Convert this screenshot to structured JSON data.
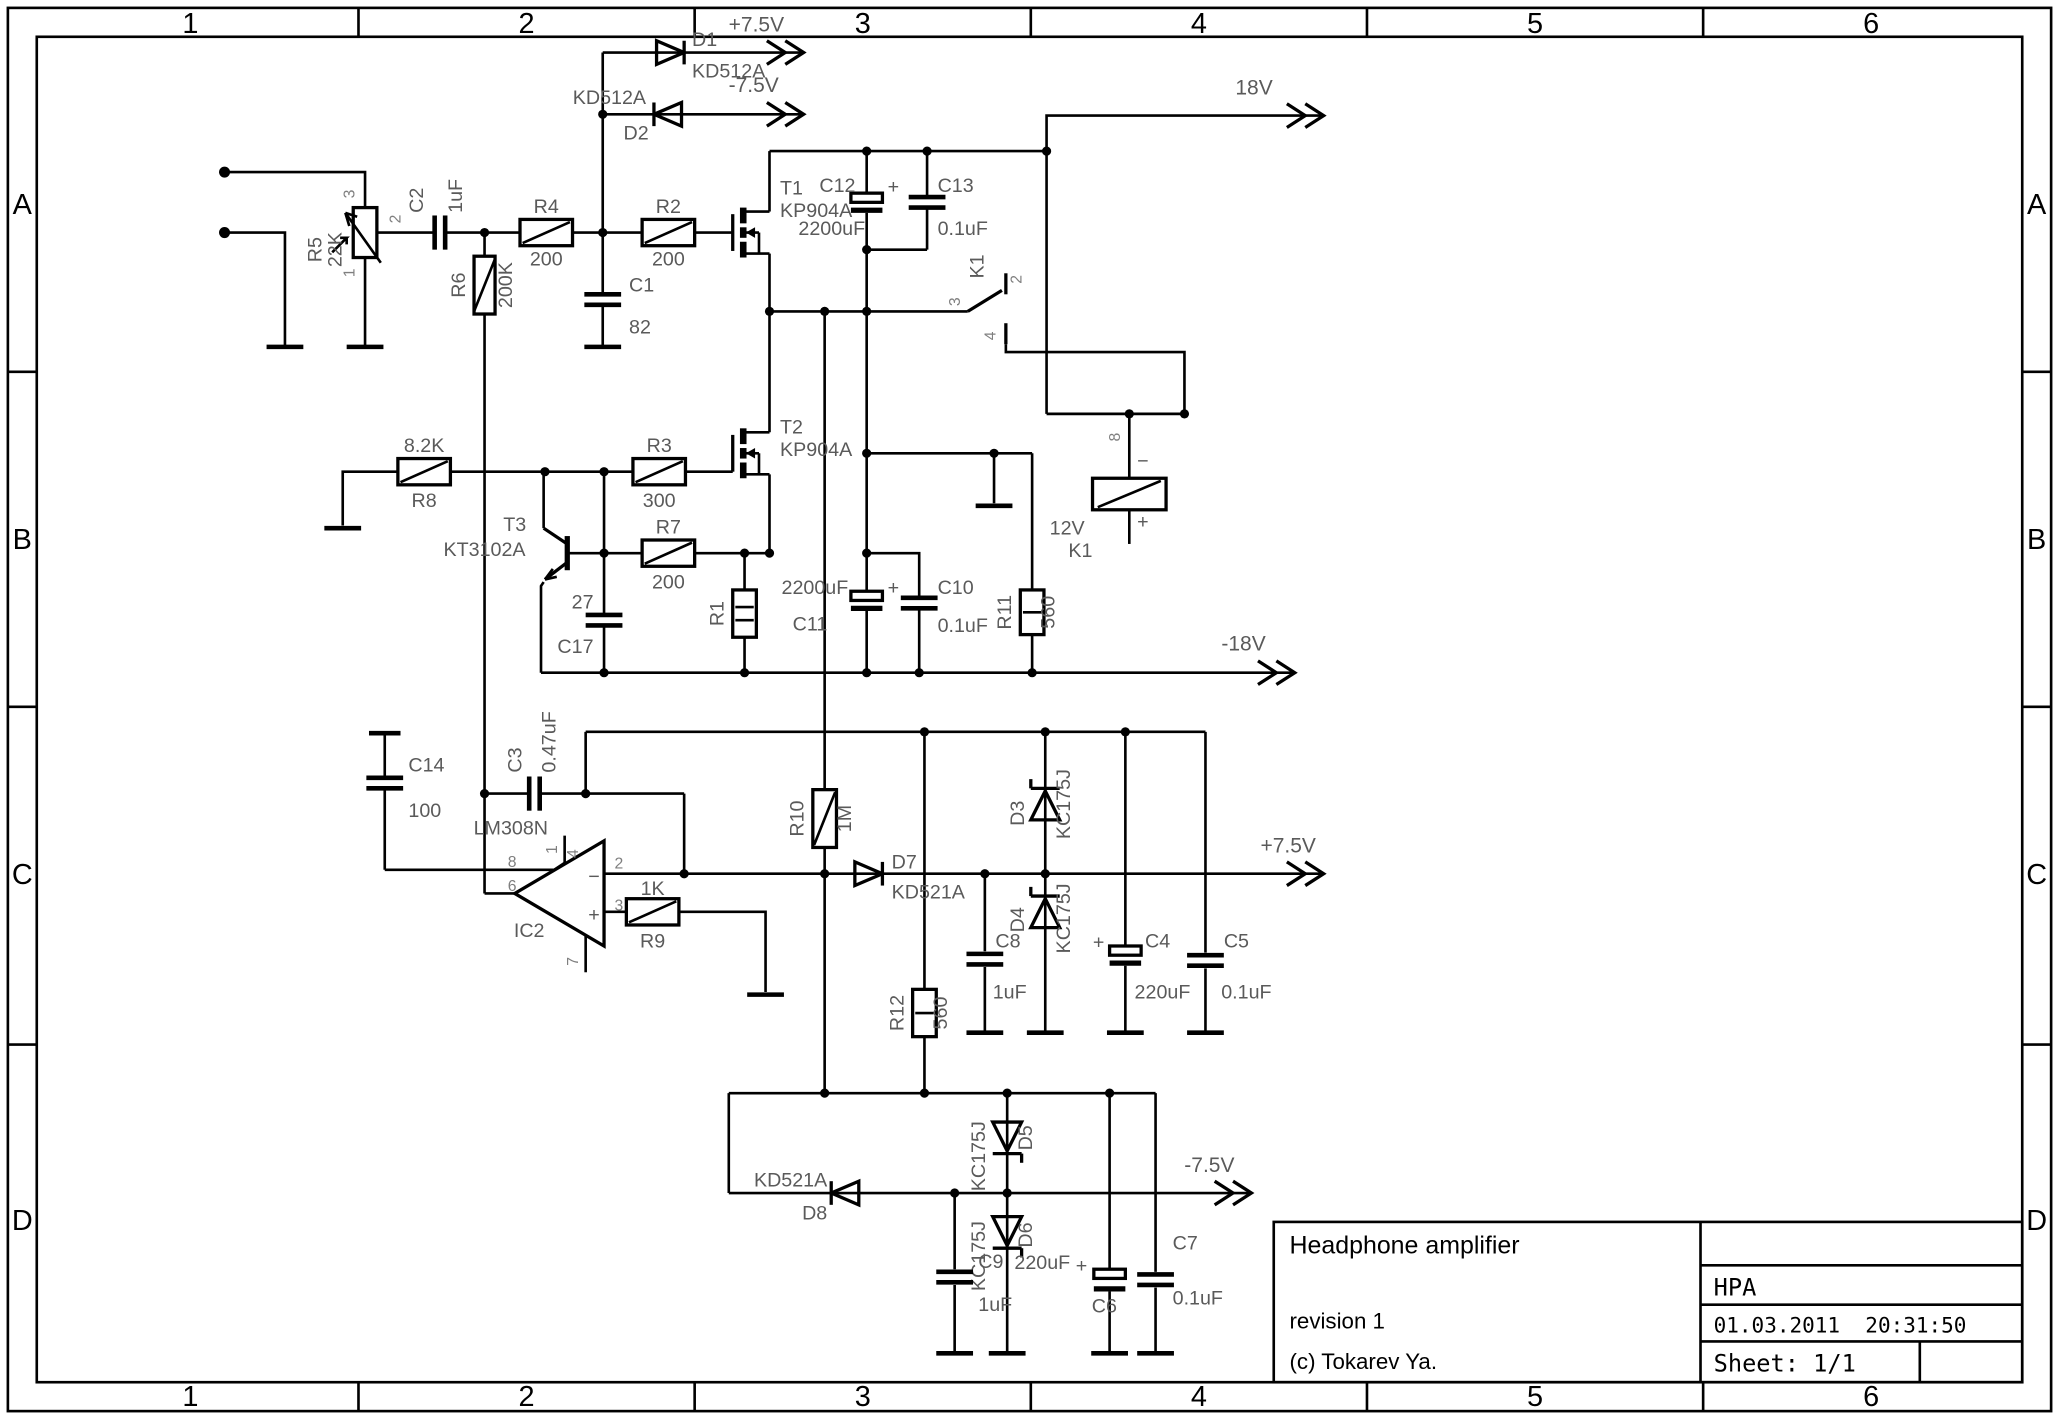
{
  "frame": {
    "columns": [
      "1",
      "2",
      "3",
      "4",
      "5",
      "6"
    ],
    "rows": [
      "A",
      "B",
      "C",
      "D"
    ]
  },
  "rails": {
    "p75_top": "+7.5V",
    "m75_top": "-7.5V",
    "p18": "18V",
    "m18": "-18V",
    "p75_mid": "+7.5V",
    "m75_bot": "-7.5V"
  },
  "title_block": {
    "title": "Headphone amplifier",
    "revision": "revision 1",
    "copyright": "(c) Tokarev Ya.",
    "code": "HPA",
    "datetime": "01.03.2011  20:31:50",
    "sheet": "Sheet: 1/1"
  },
  "colors": {
    "wire": "#000000",
    "label": "#5a5a5a",
    "background": "#ffffff"
  },
  "labels": {
    "d1_ref": "D1",
    "d1_val": "KD512A",
    "d2_ref": "D2",
    "d2_val": "KD512A",
    "r5_ref": "R5",
    "r5_val": "22K",
    "r5_p1": "1",
    "r5_p2": "2",
    "r5_p3": "3",
    "c2_ref": "C2",
    "c2_val": "1uF",
    "r6_ref": "R6",
    "r6_val": "200K",
    "r4_ref": "R4",
    "r4_val": "200",
    "c1_ref": "C1",
    "c1_val": "82",
    "r2_ref": "R2",
    "r2_val": "200",
    "t1_ref": "T1",
    "t1_val": "KP904A",
    "c12_ref": "C12",
    "c12_val": "2200uF",
    "c12_plus": "+",
    "c13_ref": "C13",
    "c13_val": "0.1uF",
    "k1sw_ref": "K1",
    "k1_p2": "2",
    "k1_p3": "3",
    "k1_p4": "4",
    "t2_ref": "T2",
    "t2_val": "KP904A",
    "r8_ref": "R8",
    "r8_val": "8.2K",
    "r3_ref": "R3",
    "r3_val": "300",
    "t3_ref": "T3",
    "t3_val": "KT3102A",
    "r7_ref": "R7",
    "r7_val": "200",
    "c17_ref": "C17",
    "c17_val": "27",
    "r1_ref": "R1",
    "c11_ref": "C11",
    "c11_val": "2200uF",
    "c11_plus": "+",
    "c10_ref": "C10",
    "c10_val": "0.1uF",
    "r11_ref": "R11",
    "r11_val": "560",
    "k1_ref": "K1",
    "k1_val": "12V",
    "k1_p8": "8",
    "k1_minus": "−",
    "k1_plus": "+",
    "c14_ref": "C14",
    "c14_val": "100",
    "c3_ref": "C3",
    "c3_val": "0.47uF",
    "ic2_ref": "IC2",
    "ic2_val": "LM308N",
    "op_p1": "1",
    "op_p2": "2",
    "op_p3": "3",
    "op_p4": "4",
    "op_p6": "6",
    "op_p7": "7",
    "op_p8": "8",
    "op_minus": "−",
    "op_plus": "+",
    "r9_ref": "R9",
    "r9_val": "1K",
    "r10_ref": "R10",
    "r10_val": "1M",
    "d7_ref": "D7",
    "d7_val": "KD521A",
    "d3_ref": "D3",
    "d3_val": "KC175J",
    "d4_ref": "D4",
    "d4_val": "KC175J",
    "c8_ref": "C8",
    "c8_val": "1uF",
    "c4_ref": "C4",
    "c4_val": "220uF",
    "c4_plus": "+",
    "c5_ref": "C5",
    "c5_val": "0.1uF",
    "r12_ref": "R12",
    "r12_val": "560",
    "d8_ref": "D8",
    "d8_val": "KD521A",
    "d5_ref": "D5",
    "d5_val": "KC175J",
    "d6_ref": "D6",
    "d6_val": "KC175J",
    "c9_ref": "C9",
    "c9_val": "1uF",
    "c6_ref": "C6",
    "c6_val": "220uF",
    "c6_plus": "+",
    "c7_ref": "C7",
    "c7_val": "0.1uF"
  }
}
